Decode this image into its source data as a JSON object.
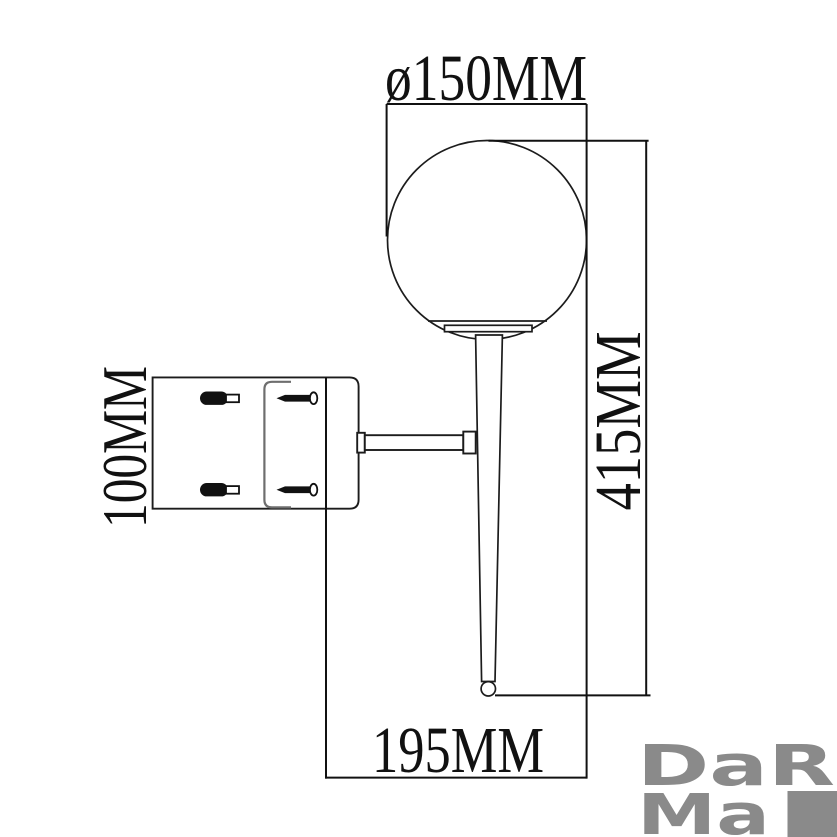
{
  "drawing": {
    "dimensions": {
      "shade_diameter": "ø150MM",
      "fixture_height": "415MM",
      "backplate_height": "100MM",
      "wall_projection": "195MM"
    }
  },
  "branding": {
    "logo_line1": "DaR",
    "logo_line2": "Ma"
  },
  "colors": {
    "line": "#1c1c1c",
    "channel": "#6e6e6e",
    "logo_gray": "#8a8a8a",
    "background": "#ffffff"
  }
}
